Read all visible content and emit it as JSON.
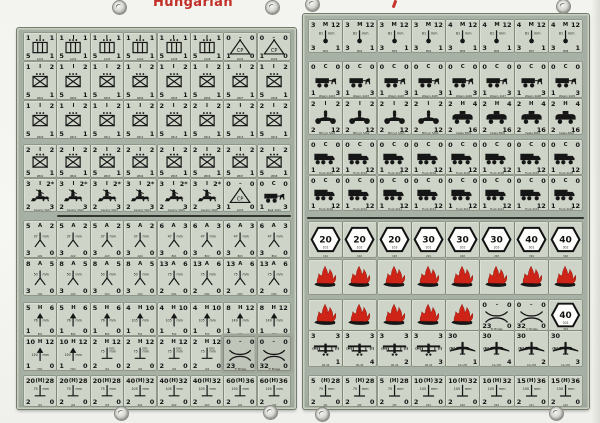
{
  "sheet": {
    "title": "Hungarian"
  },
  "labels": {
    "mm": "mm",
    "cp": "CP"
  },
  "colors": {
    "panel": "#a7b1a5",
    "counter_bg": "#ced5c8",
    "title_red": "#c03028",
    "flame_red": "#ce2417",
    "hex_fill": "#fdfdfb"
  },
  "panels": {
    "left": {
      "rows": [
        {
          "groups": [
            {
              "n": 6,
              "tl": "1",
              "tc": "I",
              "tr": "1",
              "bl": "5",
              "br": "1",
              "icon": "machinegun-icon",
              "ids": [
                "1A01",
                "1A02",
                "1A03",
                "1A04",
                "1A05",
                "1A06"
              ]
            },
            {
              "n": 2,
              "tl": "0",
              "tc": "–",
              "tr": "0",
              "bl": "1",
              "br": "0",
              "icon": "command-post-icon",
              "ids": [
                "2A01",
                "2A02"
              ]
            }
          ]
        },
        {
          "groups": [
            {
              "n": 8,
              "tl": "1",
              "tc": "I",
              "tr": "2",
              "bl": "5",
              "br": "1",
              "icon": "infantry-icon",
              "ids": [
                "1B01",
                "1B02",
                "1B03",
                "1B04",
                "1B05",
                "1B06",
                "1B07",
                "1B08"
              ]
            }
          ]
        },
        {
          "groups": [
            {
              "n": 4,
              "tl": "1",
              "tc": "I",
              "tr": "2",
              "bl": "5",
              "br": "1",
              "icon": "infantry-icon",
              "ids": [
                "1B09",
                "1B10",
                "1B11",
                "1B12"
              ]
            },
            {
              "n": 4,
              "tl": "2",
              "tc": "I",
              "tr": "2",
              "bl": "5",
              "br": "1",
              "icon": "infantry-icon",
              "ids": [
                "1B13",
                "1B14",
                "1B15",
                "1B16"
              ]
            }
          ]
        },
        {
          "groups": [
            {
              "n": 8,
              "tl": "2",
              "tc": "I",
              "tr": "2",
              "bl": "5",
              "br": "1",
              "icon": "infantry-icon",
              "ids": [
                "2B01",
                "2B02",
                "2B03",
                "2B04",
                "2B05",
                "2B06",
                "2B07",
                "2B08"
              ]
            }
          ]
        },
        {
          "groups": [
            {
              "n": 6,
              "tl": "3",
              "tc": "I",
              "tr": "2*",
              "bl": "2",
              "br": "3",
              "icon": "cavalry-icon",
              "label": "Cavalry",
              "ids": [
                "3A01",
                "3A02",
                "3A03",
                "3A04",
                "3A05",
                "3A06"
              ]
            },
            {
              "n": 1,
              "tl": "0",
              "tc": "–",
              "tr": "0",
              "bl": "1",
              "br": "0",
              "icon": "command-post-icon",
              "ids": [
                "2A03"
              ]
            },
            {
              "n": 1,
              "tl": "0",
              "tc": "C",
              "tr": "0",
              "bl": "1",
              "br": "3",
              "icon": "wagon-icon",
              "label": "Regt",
              "ids": [
                "4A01"
              ]
            }
          ]
        },
        {
          "groups": [
            {
              "n": 4,
              "tl": "5",
              "tc": "A",
              "tr": "2",
              "bl": "3",
              "br": "0",
              "icon": "at-gun-icon",
              "mm": "37",
              "ids": [
                "A01",
                "A02",
                "A03",
                "A04"
              ]
            },
            {
              "n": 4,
              "tl": "6",
              "tc": "A",
              "tr": "3",
              "bl": "3",
              "br": "0",
              "icon": "at-gun-icon",
              "mm": "47",
              "ids": [
                "B01",
                "B02",
                "B03",
                "B04"
              ]
            }
          ]
        },
        {
          "groups": [
            {
              "n": 4,
              "tl": "8",
              "tc": "A",
              "tr": "5",
              "bl": "3",
              "br": "0",
              "icon": "at-gun-icon",
              "mm": "50",
              "ids": [
                "C01",
                "C02",
                "C03",
                "C04"
              ]
            },
            {
              "n": 4,
              "tl": "13",
              "tc": "A",
              "tr": "6",
              "bl": "2",
              "br": "0",
              "icon": "at-gun-icon",
              "mm": "75",
              "ids": [
                "D01",
                "D02",
                "D03",
                "D04"
              ]
            }
          ]
        },
        {
          "groups": [
            {
              "n": 3,
              "tl": "5",
              "tc": "H",
              "tr": "6",
              "bl": "1",
              "br": "0",
              "icon": "howitzer-icon",
              "mm": "76",
              "ids": [
                "E01",
                "E02",
                "E03"
              ]
            },
            {
              "n": 3,
              "tl": "4",
              "tc": "H",
              "tr": "10",
              "bl": "1",
              "br": "0",
              "icon": "howitzer-icon",
              "mm": "105",
              "ids": [
                "F01",
                "F02",
                "F03"
              ]
            },
            {
              "n": 2,
              "tl": "8",
              "tc": "H",
              "tr": "12",
              "bl": "1",
              "br": "0",
              "icon": "howitzer-icon",
              "mm": "149",
              "ids": [
                "G01",
                "G02"
              ]
            }
          ]
        },
        {
          "groups": [
            {
              "n": 2,
              "tl": "10",
              "tc": "H",
              "tr": "12",
              "bl": "1",
              "br": "0",
              "icon": "howitzer-icon",
              "mm": "150",
              "ids": [
                "H01",
                "H02"
              ]
            },
            {
              "n": 4,
              "tl": "2",
              "tc": "H",
              "tr": "12",
              "bl": "2",
              "br": "0",
              "icon": "mountain-gun-icon",
              "mm": "75",
              "sup": "DR2",
              "ids": [
                "I01",
                "I02",
                "I03",
                "I04"
              ]
            },
            {
              "n": 1,
              "tl": "0",
              "tc": "–",
              "tr": "0",
              "bl": "23",
              "br": "0",
              "icon": "bridge-icon",
              "label": "'P' Bridge",
              "dark": true
            },
            {
              "n": 1,
              "tl": "0",
              "tc": "–",
              "tr": "0",
              "bl": "32",
              "br": "0",
              "icon": "bridge-icon",
              "label": "'P' Bridge",
              "dark": true
            }
          ]
        },
        {
          "groups": [
            {
              "n": 3,
              "tl": "20",
              "tc": "(H)",
              "tr": "28",
              "bl": "2",
              "br": "0",
              "icon": "field-gun-icon",
              "mm": "75",
              "ids": [
                "J01",
                "J02",
                "J03"
              ]
            },
            {
              "n": 3,
              "tl": "40",
              "tc": "(H)",
              "tr": "32",
              "bl": "2",
              "br": "0",
              "icon": "field-gun-icon",
              "mm": "105",
              "ids": [
                "K01",
                "K02",
                "K03"
              ]
            },
            {
              "n": 2,
              "tl": "60",
              "tc": "(H)",
              "tr": "36",
              "bl": "2",
              "br": "0",
              "icon": "field-gun-icon",
              "mm": "150",
              "ids": [
                "L01",
                "L02"
              ]
            }
          ]
        }
      ]
    },
    "right": {
      "rows": [
        {
          "groups": [
            {
              "n": 4,
              "tl": "3",
              "tc": "M",
              "tr": "12",
              "bl": "3",
              "br": "1",
              "icon": "mortar-icon",
              "mm": "81",
              "ids": [
                "M01",
                "M02",
                "M03",
                "M04"
              ]
            },
            {
              "n": 4,
              "tl": "4",
              "tc": "M",
              "tr": "12",
              "bl": "3",
              "br": "1",
              "icon": "mortar-icon",
              "mm": "81",
              "ids": [
                "M05",
                "M06",
                "M07",
                "M08"
              ]
            }
          ]
        },
        {
          "groups": [
            {
              "n": 8,
              "tl": "0",
              "tc": "C",
              "tr": "0",
              "bl": "1",
              "br": "3",
              "icon": "wagon-icon",
              "label": "Wagon",
              "ids": [
                "4A02",
                "4A03",
                "4A04",
                "4A05",
                "4A06",
                "4A07",
                "4A08",
                "4A09"
              ]
            }
          ]
        },
        {
          "groups": [
            {
              "n": 4,
              "tl": "2",
              "tc": "I",
              "tr": "2",
              "bl": "2",
              "br": "12",
              "icon": "motorcycle-icon",
              "label": "Mtrcycl",
              "ids": [
                "5A01",
                "5A02",
                "5A03",
                "5A04"
              ]
            },
            {
              "n": 4,
              "tl": "2",
              "tc": "H",
              "tr": "4",
              "bl": "2",
              "br": "16",
              "icon": "armored-car-icon",
              "label": "Csaba",
              "ids": [
                "5B01",
                "5B02",
                "5B03",
                "5B04"
              ]
            }
          ]
        },
        {
          "groups": [
            {
              "n": 8,
              "tl": "0",
              "tc": "C",
              "tr": "0",
              "bl": "1",
              "br": "12",
              "icon": "truck-icon",
              "label": "Truck",
              "ids": [
                "4C01",
                "4C02",
                "4C03",
                "4C04",
                "4C05",
                "4C06",
                "4C07",
                "4C08"
              ]
            }
          ]
        },
        {
          "groups": [
            {
              "n": 8,
              "tl": "0",
              "tc": "C",
              "tr": "0",
              "bl": "1",
              "br": "12",
              "icon": "truck-icon",
              "label": "Truck",
              "ids": [
                "4C09",
                "4C10",
                "4C11",
                "4C12",
                "4C13",
                "4C14",
                "4C15",
                "4C16"
              ]
            }
          ]
        },
        {
          "groups": [
            {
              "n": 8,
              "icon": "hex-marker-icon",
              "values": [
                "20",
                "20",
                "20",
                "30",
                "30",
                "30",
                "40",
                "40"
              ],
              "ids": [
                "101",
                "102",
                "103",
                "201",
                "202",
                "203",
                "301",
                "302"
              ]
            }
          ]
        },
        {
          "groups": [
            {
              "n": 8,
              "icon": "burning-wreck-icon"
            }
          ]
        },
        {
          "groups": [
            {
              "n": 5,
              "icon": "burning-wreck-icon"
            },
            {
              "n": 1,
              "tl": "0",
              "tc": "–",
              "tr": "0",
              "bl": "23",
              "br": "0",
              "icon": "bridge-icon",
              "label": "'B' Bridge"
            },
            {
              "n": 1,
              "tl": "0",
              "tc": "–",
              "tr": "0",
              "bl": "32",
              "br": "0",
              "icon": "bridge-icon",
              "label": "'C' Bridge"
            },
            {
              "n": 1,
              "icon": "hex-marker-icon",
              "values": [
                "40"
              ],
              "ids": [
                "303"
              ]
            }
          ]
        },
        {
          "groups": [
            {
              "n": 4,
              "tl": "3",
              "tr": "3",
              "side_l": "(H)",
              "side_r": "(I)",
              "icon": "biplane-icon",
              "label": "CR-42",
              "nums": [
                "1",
                "4",
                "2",
                "3"
              ]
            },
            {
              "n": 4,
              "tl": "30",
              "side_l": "(H)",
              "icon": "bomber-icon",
              "label": "CA-135",
              "nums": [
                "1",
                "4",
                "2",
                "3"
              ]
            }
          ]
        },
        {
          "groups": [
            {
              "n": 3,
              "tl": "5",
              "tc": "(H)",
              "tr": "28",
              "bl": "2",
              "br": "0",
              "icon": "field-gun-icon",
              "mm": "75",
              "ids": [
                "J01",
                "J02",
                "J03"
              ]
            },
            {
              "n": 3,
              "tl": "10",
              "tc": "(H)",
              "tr": "32",
              "bl": "2",
              "br": "0",
              "icon": "field-gun-icon",
              "mm": "105",
              "ids": [
                "K01",
                "K02",
                "K03"
              ]
            },
            {
              "n": 2,
              "tl": "15",
              "tc": "(H)",
              "tr": "36",
              "bl": "2",
              "br": "0",
              "icon": "field-gun-icon",
              "mm": "150",
              "ids": [
                "L01",
                "L02"
              ]
            }
          ]
        }
      ]
    }
  }
}
